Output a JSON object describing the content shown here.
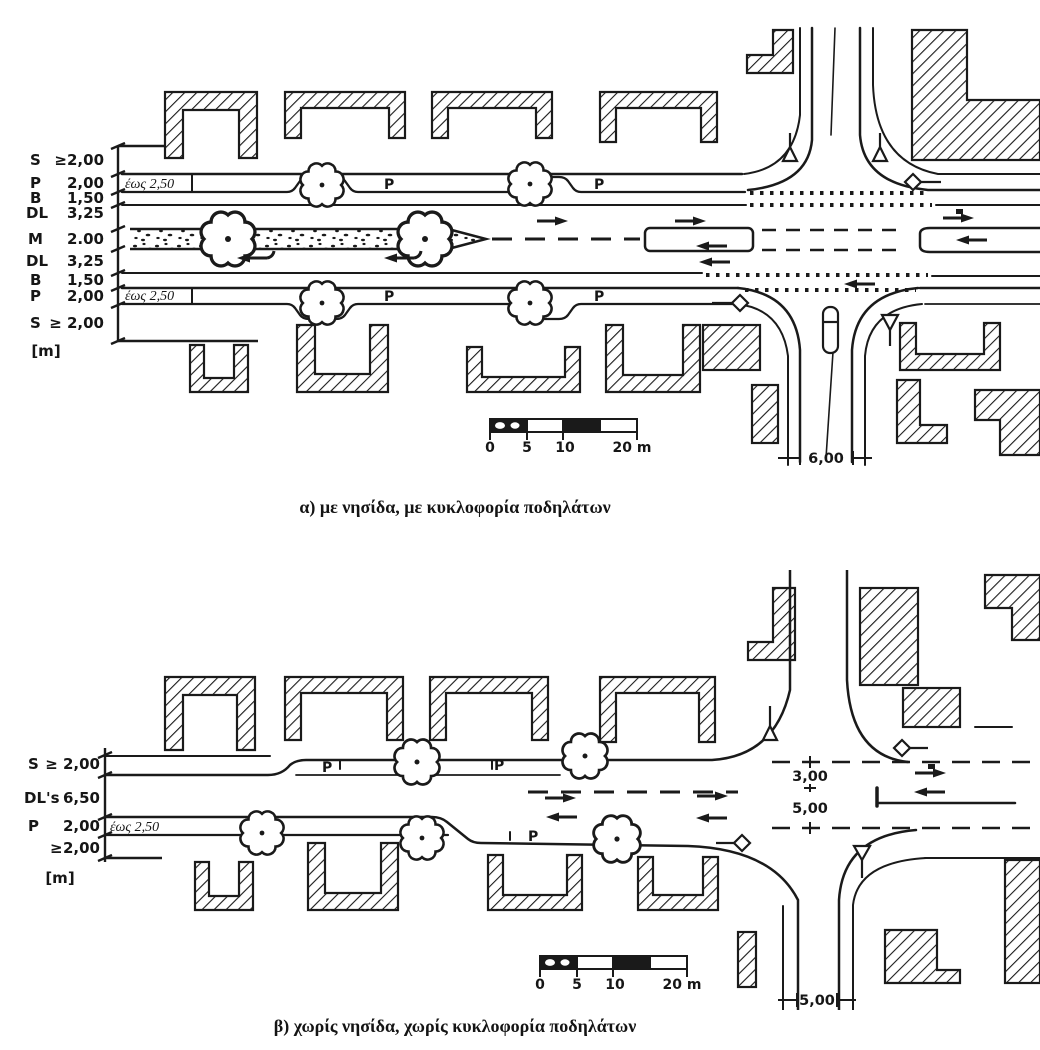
{
  "ink": "#1a1a1a",
  "figure_a": {
    "caption": "α)  με νησίδα, με κυκλοφορία ποδηλάτων",
    "scale_rows": [
      {
        "code": "S",
        "value": "≥2,00"
      },
      {
        "code": "P",
        "value": "2,00"
      },
      {
        "code": "B",
        "value": "1,50"
      },
      {
        "code": "DL",
        "value": "3,25"
      },
      {
        "code": "M",
        "value": "2.00"
      },
      {
        "code": "DL",
        "value": "3,25"
      },
      {
        "code": "B",
        "value": "1,50"
      },
      {
        "code": "P",
        "value": "2,00"
      },
      {
        "code": "S",
        "value": "≥ 2,00"
      }
    ],
    "unit": "[m]",
    "upto_label": "έως 2,50",
    "parking_letter": "P",
    "cross_width": "6,00",
    "scale_bar": {
      "t0": "0",
      "t1": "5",
      "t2": "10",
      "t3": "20 m"
    }
  },
  "figure_b": {
    "caption": "β)  χωρίς νησίδα, χωρίς κυκλοφορία ποδηλάτων",
    "scale_rows": [
      {
        "code": "S",
        "value": "≥ 2,00"
      },
      {
        "code": "DL's",
        "value": "6,50"
      },
      {
        "code": "P",
        "value": "2,00"
      },
      {
        "code": "≥",
        "value": "2,00"
      }
    ],
    "unit": "[m]",
    "upto_label": "έως 2,50",
    "parking_letter": "P",
    "dim_east_top": "3,00",
    "dim_east_bottom": "5,00",
    "cross_width": "5,00",
    "scale_bar": {
      "t0": "0",
      "t1": "5",
      "t2": "10",
      "t3": "20 m"
    }
  }
}
